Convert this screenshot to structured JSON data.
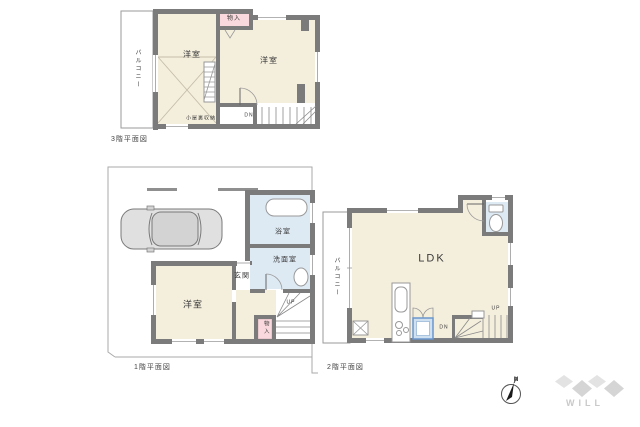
{
  "floor3": {
    "caption": "3階平面図",
    "balcony": "バルコニー",
    "room_left": "洋室",
    "room_right": "洋室",
    "closet": "物入",
    "attic_storage": "小屋裏収納",
    "stairs_down": "DN"
  },
  "floor1": {
    "caption": "1階平面図",
    "bathroom": "浴室",
    "washroom": "洗面室",
    "entrance": "玄関",
    "bedroom": "洋室",
    "closet": "物入",
    "stairs_up": "UP"
  },
  "floor2": {
    "caption": "2階平面図",
    "balcony": "バルコニー",
    "living": "LDK",
    "stairs_down": "DN",
    "stairs_up": "UP"
  },
  "compass": {
    "north_label": "N"
  },
  "brand": {
    "logo_text": "WILL"
  },
  "colors": {
    "wall_gray": "#7b7b7b",
    "room_cream": "#f4eedc",
    "wet_blue": "#dde9f3",
    "closet_pink": "#f9d9dd",
    "appliance_blue": "#6a96cc",
    "logo_gray": "#d4d4d4"
  }
}
